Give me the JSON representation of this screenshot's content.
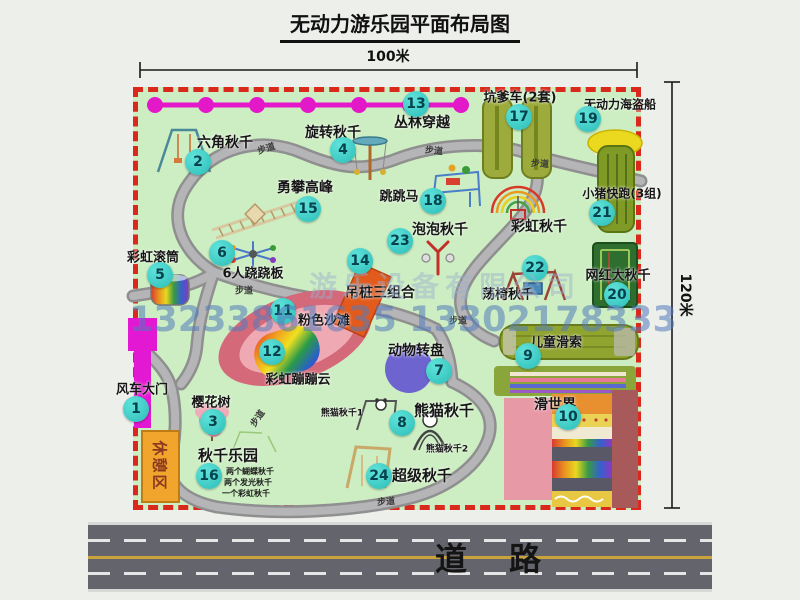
{
  "title": "无动力游乐园平面布局图",
  "dimensions": {
    "top_scale": "100米",
    "right_scale": "120米"
  },
  "road": {
    "label": "道路"
  },
  "watermark": {
    "company": "游乐设备有限公司",
    "phone": "13233861635 13302178333"
  },
  "map": {
    "walkway_label": "步道",
    "rest_area_label": "休憩区",
    "rainbow_swing_label": "彩虹秋千",
    "panda_swing_1": "熊猫秋千1",
    "panda_swing_2": "熊猫秋千2",
    "swing_park_details": [
      "两个蝴蝶秋千",
      "两个发光秋千",
      "一个彩虹秋千"
    ],
    "attractions": [
      {
        "num": "1",
        "name": "风车大门"
      },
      {
        "num": "2",
        "name": "六角秋千"
      },
      {
        "num": "3",
        "name": "樱花树"
      },
      {
        "num": "4",
        "name": "旋转秋千"
      },
      {
        "num": "5",
        "name": "彩虹滚筒"
      },
      {
        "num": "6",
        "name": "6人跷跷板"
      },
      {
        "num": "7",
        "name": "动物转盘"
      },
      {
        "num": "8",
        "name": "熊猫秋千"
      },
      {
        "num": "9",
        "name": "儿童滑索"
      },
      {
        "num": "10",
        "name": "滑世界"
      },
      {
        "num": "11",
        "name": "粉色沙滩"
      },
      {
        "num": "12",
        "name": "彩虹蹦蹦云"
      },
      {
        "num": "13",
        "name": "丛林穿越"
      },
      {
        "num": "14",
        "name": "吊桩三组合"
      },
      {
        "num": "15",
        "name": "勇攀高峰"
      },
      {
        "num": "16",
        "name": "秋千乐园"
      },
      {
        "num": "17",
        "name": "坑爹车(2套)"
      },
      {
        "num": "18",
        "name": "跳跳马"
      },
      {
        "num": "19",
        "name": "无动力海盗船"
      },
      {
        "num": "20",
        "name": "网红大秋千"
      },
      {
        "num": "21",
        "name": "小猪快跑(3组)"
      },
      {
        "num": "22",
        "name": "荡椅秋千"
      },
      {
        "num": "23",
        "name": "泡泡秋千"
      },
      {
        "num": "24",
        "name": "超级秋千"
      }
    ]
  },
  "colors": {
    "badge": "#3ccfc9",
    "map_green": "#cdeec2",
    "border_red": "#da291c",
    "zipline_magenta": "#e318c8",
    "gate_magenta": "#e218d2",
    "rest_orange": "#f2a52c",
    "road_gray": "#64646c"
  }
}
